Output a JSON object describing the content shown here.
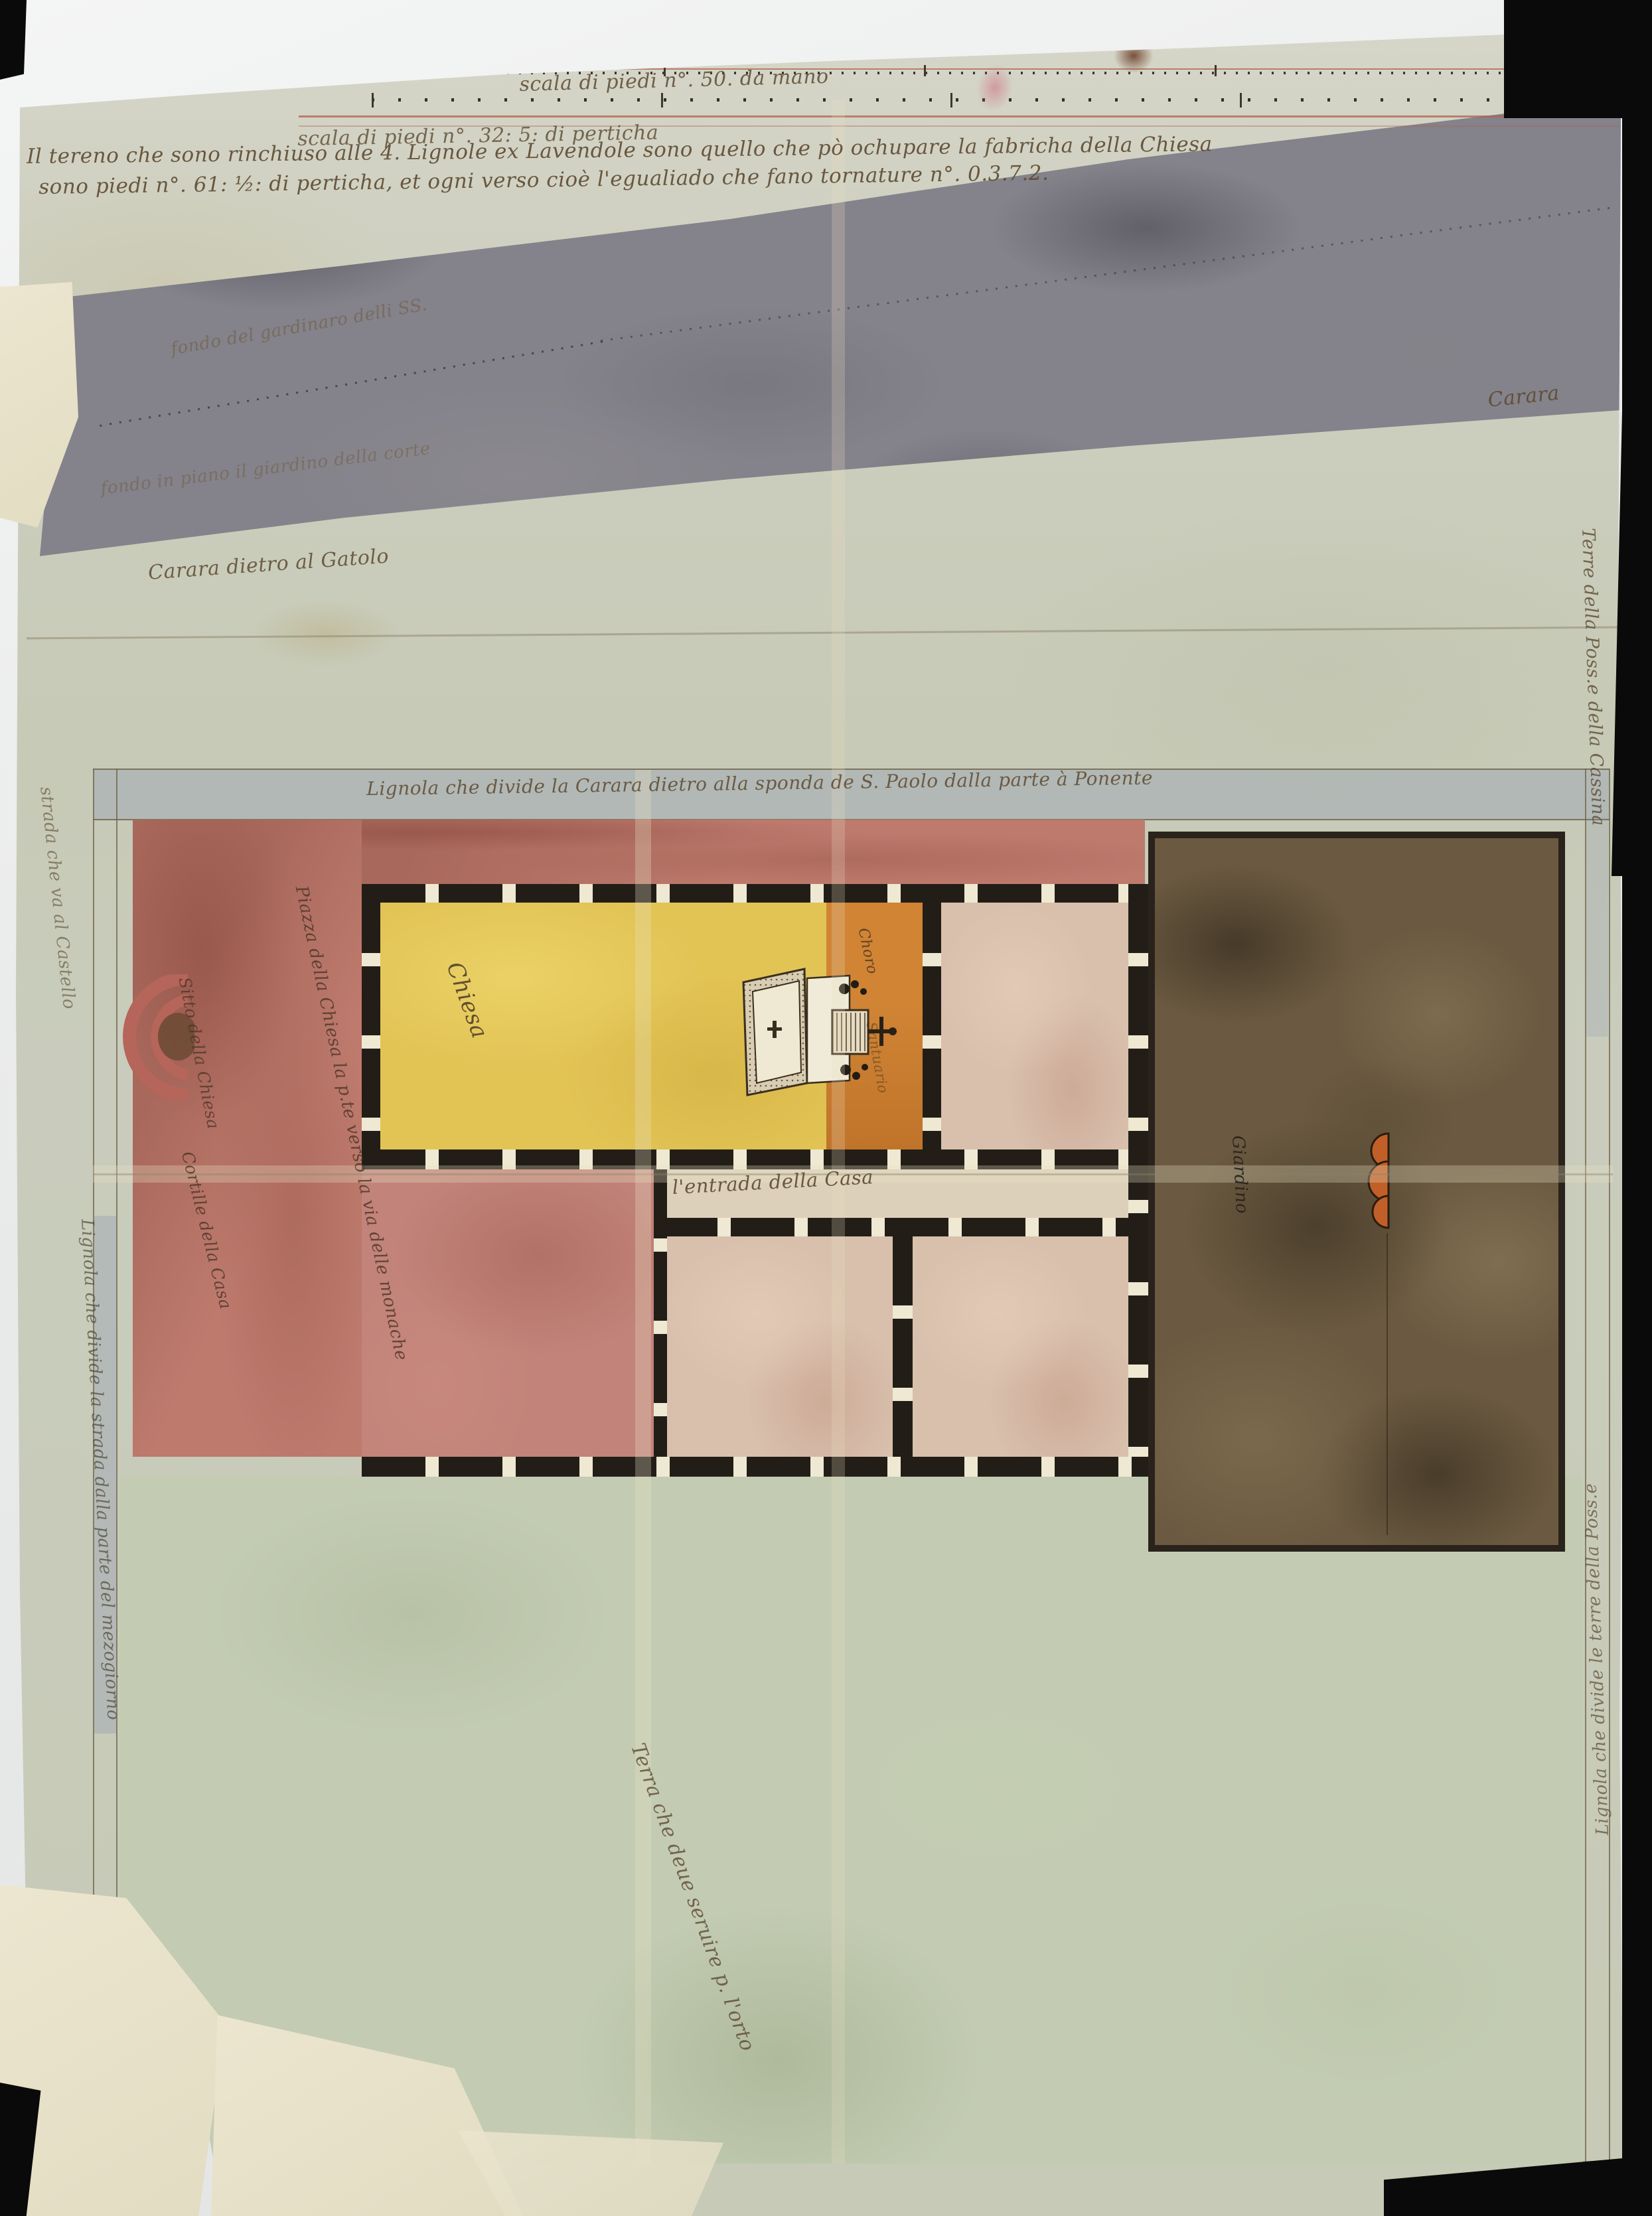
{
  "document": {
    "kind": "16th-century watercolour site plan of a church and farm (scanned manuscript)",
    "orientation_note": "plan bordered by surveyor lines (lignole)"
  },
  "texts": {
    "scale1": "scala di piedi n°. 50. da mano",
    "scale2": "scala di piedi n°. 32: 5: di perticha",
    "para1": "Il tereno che sono rinchiuso alle 4. Lignole ex Lavendole sono quello che pò ochupare la fabricha della Chiesa",
    "para2": "sono piedi n°. 61: ½: di perticha, et ogni verso cioè l'egualiado che fano tornature n°. 0.3.7.2.",
    "gray1": "fondo del gardinaro delli SS.",
    "gray2": "fondo in piano il giardino della corte",
    "carara_left": "Carara dietro al Gatolo",
    "carara_right": "Carara",
    "terre_cassina": "Terre della Poss.e della Cassina",
    "lignola_top": "Lignola che divide la Carara dietro alla sponda de S. Paolo dalla parte à Ponente",
    "strada_castello": "strada che va al Castello",
    "piazza": "Piazza della Chiesa la p.te verso la via delle monache",
    "sitto": "Sitto della Chiesa",
    "cortile": "Cortille della Casa",
    "chiesa": "Chiesa",
    "choro": "Choro",
    "santuario": "Santuario",
    "entrada": "l'entrada della Casa",
    "giardino": "Giardino",
    "terra_orto": "Terra che deue seruire p. l'orto",
    "lignola_left": "Lignola che divide la strada dalla parte del mezogiorno",
    "lignola_right": "Lignola che divide le terre della Poss.e"
  },
  "figures": {
    "altar_sketch": "altar-perspective-sketch",
    "fountain": "trefoil-fountain",
    "exedra": "red-arc-exedra",
    "dotted_survey_line": "dotted-survey-line"
  },
  "colors": {
    "parchment": "#cfd1c0",
    "gray_wash": "#84828a",
    "pink_piazza": "#bd7a6d",
    "yellow_church": "#e2c455",
    "orange_choir": "#cd7f30",
    "garden_brown": "#6b5a41",
    "field_green": "#c3ccb2",
    "ink": "#5d4a32",
    "wall_black": "#221e17",
    "blue_border_wash": "#7a88b0",
    "scale_red": "#b0604e",
    "cream_patch": "#e9e3cd",
    "scanner_black": "#0b0a0a"
  }
}
